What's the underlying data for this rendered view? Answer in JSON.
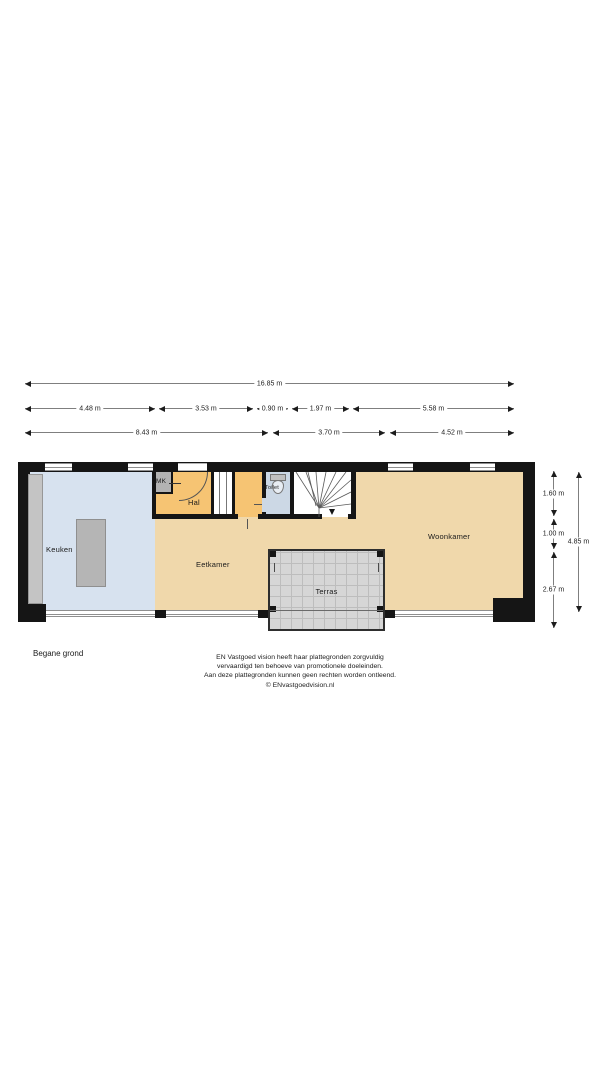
{
  "floor_label": "Begane grond",
  "rooms": {
    "keuken": "Keuken",
    "eetkamer": "Eetkamer",
    "woonkamer": "Woonkamer",
    "hal": "Hal",
    "mk": "MK",
    "toilet": "Toilet",
    "terras": "Terras"
  },
  "dimensions": {
    "total_width": "16.85 m",
    "row2": [
      "4.48 m",
      "3.53 m",
      "0.90 m",
      "1.97 m",
      "5.58 m"
    ],
    "row3": [
      "8.43 m",
      "3.70 m",
      "4.52 m"
    ],
    "right_inner": [
      "1.60 m",
      "1.00 m",
      "2.67 m"
    ],
    "right_total": "4.85 m"
  },
  "footer": {
    "lines": [
      "EN Vastgoed vision heeft haar plattegronden zorgvuldig",
      "vervaardigd ten behoeve van promotionele doeleinden.",
      "Aan deze plattegronden kunnen geen rechten worden ontleend.",
      "© ENvastgoedvision.nl"
    ]
  },
  "colors": {
    "wall": "#151515",
    "floor_beige": "#f0d8ab",
    "floor_kitchen_blue": "#d7e2ef",
    "floor_orange": "#f6c473",
    "floor_toilet_blue": "#ccd8e5",
    "terrace_gray": "#d6d6d6",
    "furniture_gray": "#b5b5b5"
  }
}
